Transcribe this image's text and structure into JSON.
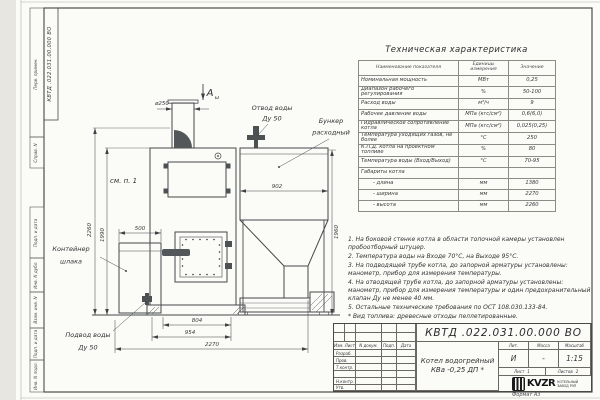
{
  "corner_stamp": {
    "designation": "КВТД .022.031.00.000 ВО"
  },
  "margin_labels": {
    "perv": "Перв. примен.",
    "sprav": "Справ. N",
    "podp1": "Подп. и дата",
    "inv_dubl": "Инв. N дубл.",
    "vzam": "Взам. инв. N",
    "podp2": "Подп. и дата",
    "inv_podl": "Инв. N подл."
  },
  "format_label": "Формат А3",
  "drawing": {
    "view_label": "А",
    "view_sub": "ω",
    "see_note": "см. п. 1",
    "dim_d250": "ø250",
    "dim_500": "500",
    "dim_902": "902",
    "dim_804": "804",
    "dim_954": "954",
    "dim_2270": "2270",
    "dim_2260": "2260",
    "dim_1990": "1990",
    "dim_1960": "1960",
    "outlet_l1": "Отвод воды",
    "outlet_l2": "Ду 50",
    "bunker_l1": "Бункер",
    "bunker_l2": "расходный",
    "slag_l1": "Контейнер",
    "slag_l2": "шлака",
    "inlet_l1": "Подвод воды",
    "inlet_l2": "Ду 50"
  },
  "spec_table": {
    "title": "Техническая характеристика",
    "headers": [
      "Наименование показателя",
      "Единицы измерения",
      "Значение"
    ],
    "rows": [
      [
        "Номинальная мощность",
        "МВт",
        "0,25"
      ],
      [
        "Диапазон рабочего регулирования",
        "%",
        "50-100"
      ],
      [
        "Расход воды",
        "м³/ч",
        "9"
      ],
      [
        "Рабочее давление воды",
        "МПа (кгс/см²)",
        "0,6(6,0)"
      ],
      [
        "Гидравлическое сопротивление котла",
        "МПа (кгс/см²)",
        "0,025(0,25)"
      ],
      [
        "Температура уходящих газов, не более",
        "°С",
        "250"
      ],
      [
        "К.П.Д. котла на проектном топливе",
        "%",
        "80"
      ],
      [
        "Температура воды (Вход/Выход)",
        "°С",
        "70-95"
      ],
      [
        "Габариты котла",
        "",
        ""
      ],
      [
        "- длина",
        "мм",
        "1380"
      ],
      [
        "- ширина",
        "мм",
        "2270"
      ],
      [
        "- высота",
        "мм",
        "2260"
      ]
    ]
  },
  "notes": [
    "1. На боковой стенке котла в области топочной камеры установлен пробоотборный штуцер.",
    "2. Температура воды на Входе 70°С, на Выходе 95°С.",
    "3. На подводящей трубе котла, до запорной арматуры установлены: манометр, прибор для измерения температуры.",
    "4. На отводящей трубе котла, до запорной арматуры установлены: манометр, прибор для измерения температуры и один предохранительный клапан Ду не менее 40 мм.",
    "5. Остальные технические требования по ОСТ 108.030.133-84."
  ],
  "fuel_note": "* Вид топлива: древесные отходы пеллетированные.",
  "title_block": {
    "designation": "КВТД .022.031.00.000 ВО",
    "name_l1": "Котел водогрейный",
    "name_l2": "КВа -0,25  ДП *",
    "col_izm": "Изм. Лист",
    "col_doc": "N докум.",
    "col_podp": "Подп.",
    "col_data": "Дата",
    "roles": [
      "Разраб.",
      "Пров.",
      "Т.контр.",
      "",
      "Н.контр.",
      "Утв."
    ],
    "lit_label": "Лит.",
    "mass_label": "Масса",
    "scale_label": "Масштаб",
    "lit_value": "И",
    "mass_value": "-",
    "scale_value": "1:15",
    "sheet_label": "Лист",
    "sheet_value": "1",
    "sheets_label": "Листов",
    "sheets_value": "2",
    "logo_text": "KVZR",
    "company_l1": "КОТЕЛЬНЫЙ",
    "company_l2": "ЗАВОД РЭП"
  }
}
